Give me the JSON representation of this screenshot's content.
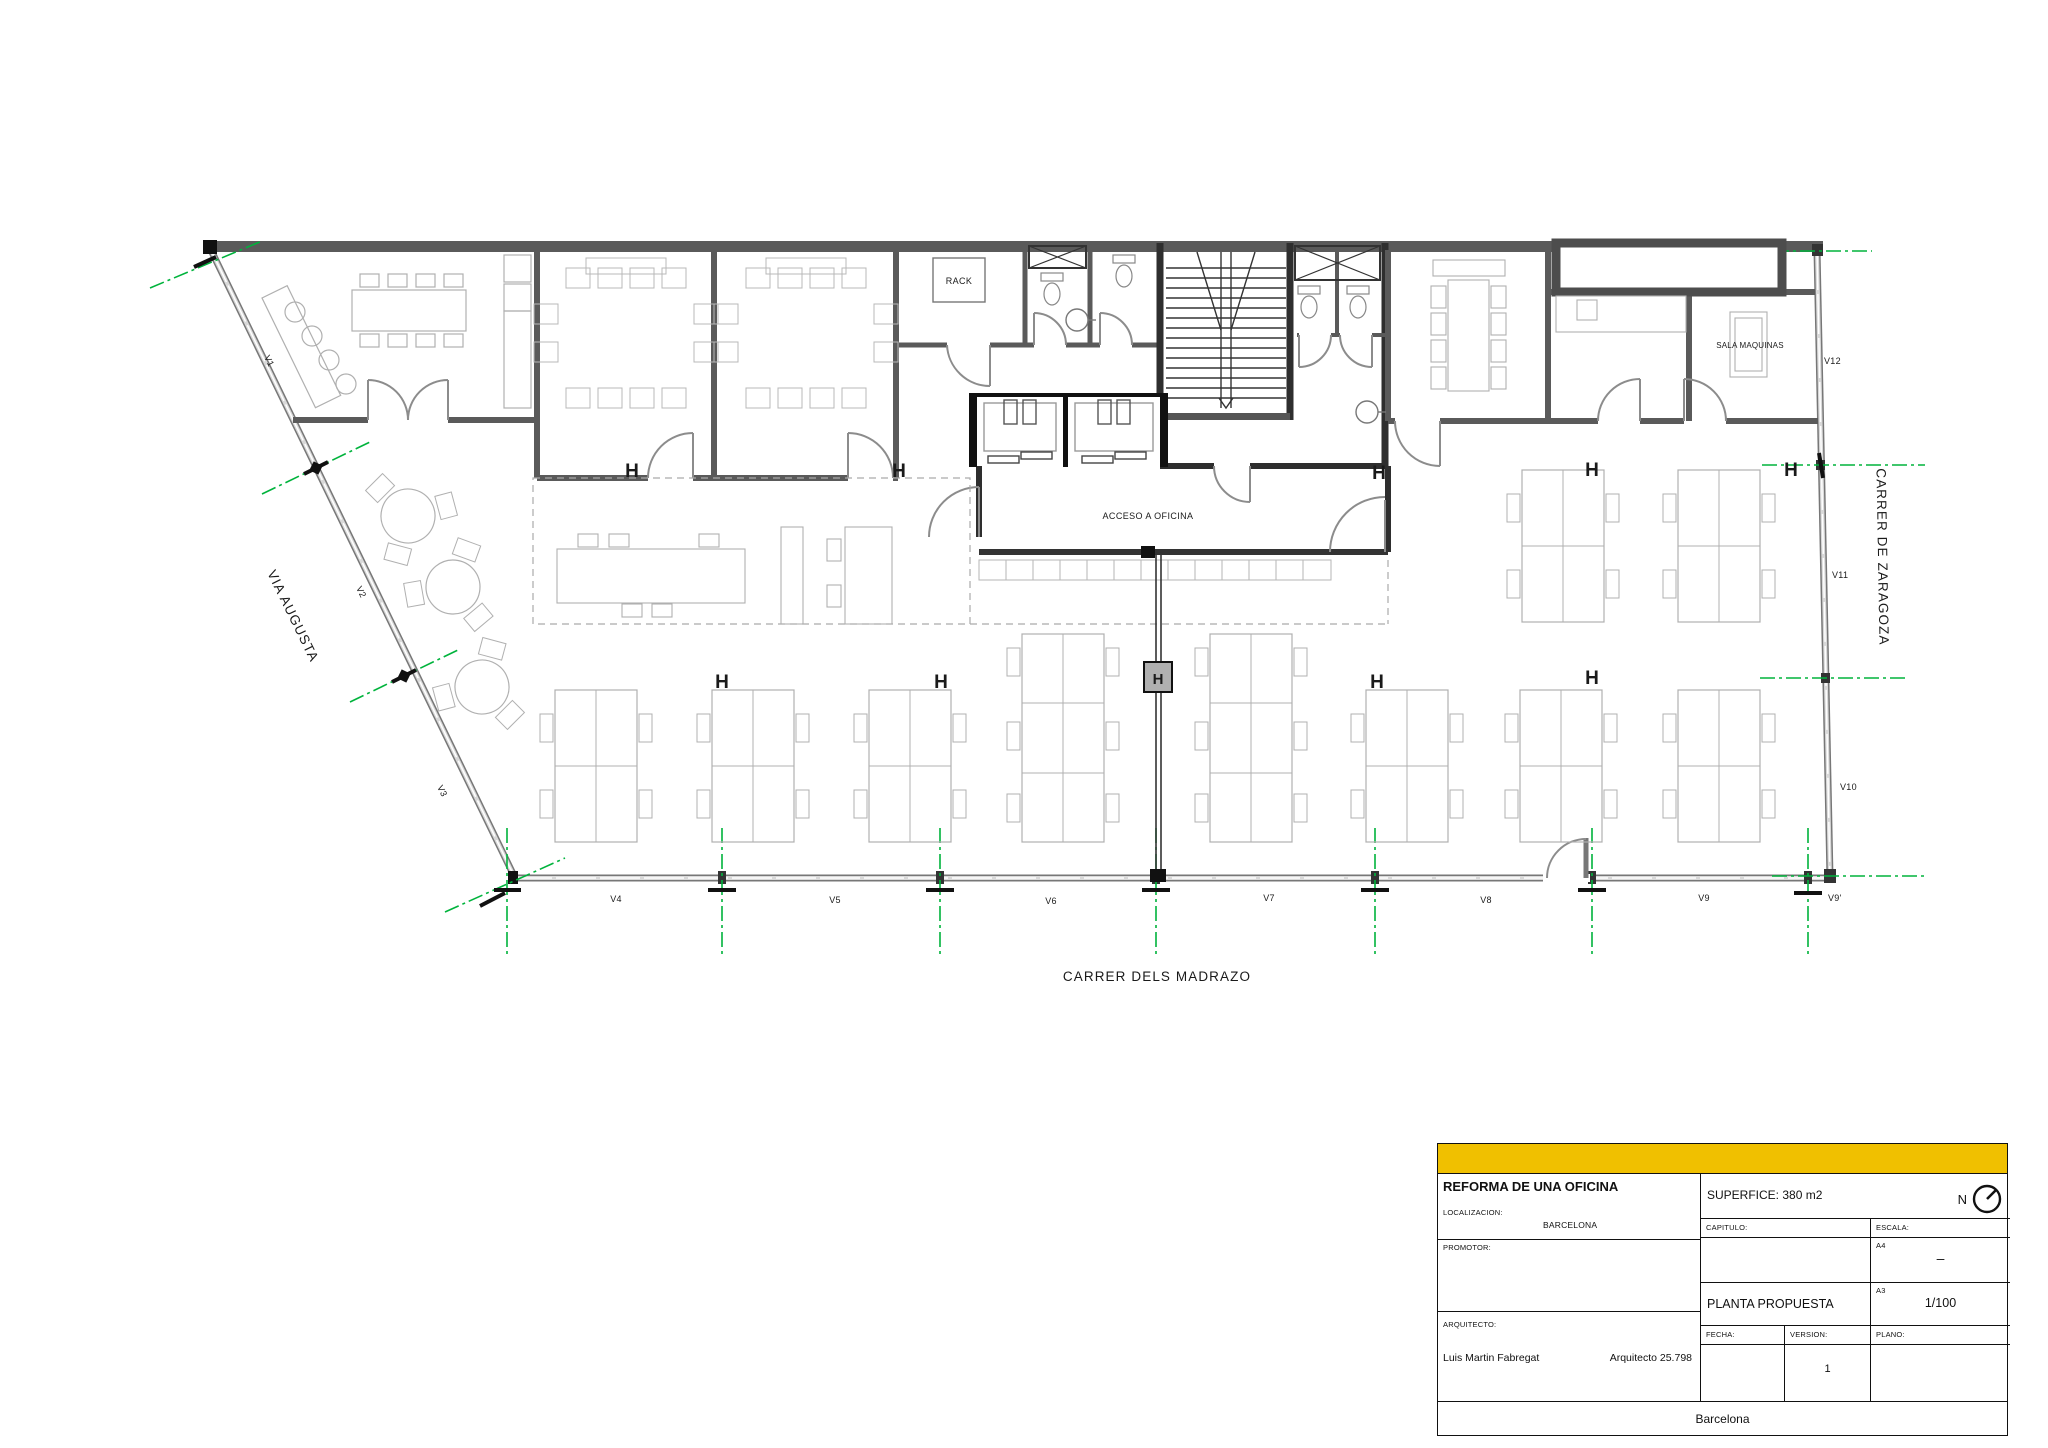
{
  "plan": {
    "streets": {
      "left": "VIA AUGUSTA",
      "bottom": "CARRER DELS MADRAZO",
      "right": "CARRER DE ZARAGOZA"
    },
    "rooms": {
      "rack": "RACK",
      "sala_maquinas": "SALA MAQUINAS",
      "acceso": "ACCESO A OFICINA"
    },
    "windows": [
      "V1",
      "V2",
      "V3",
      "V4",
      "V5",
      "V6",
      "V7",
      "V8",
      "V9",
      "V9'",
      "V10",
      "V11",
      "V12"
    ],
    "column_marker": "H",
    "axis_color": "#00b33c"
  },
  "title_block": {
    "accent_color": "#f0c000",
    "project_title": "REFORMA DE UNA OFICINA",
    "localizacion_label": "LOCALIZACION:",
    "localizacion_value": "BARCELONA",
    "promotor_label": "PROMOTOR:",
    "arquitecto_label": "ARQUITECTO:",
    "arquitecto_name": "Luis Martin Fabregat",
    "arquitecto_number": "Arquitecto 25.798",
    "superficie": "SUPERFICE: 380 m2",
    "north_letter": "N",
    "capitulo_label": "CAPITULO:",
    "escala_label": "ESCALA:",
    "a4_label": "A4",
    "a4_value": "–",
    "plano_title": "PLANTA PROPUESTA",
    "a3_label": "A3",
    "a3_value": "1/100",
    "fecha_label": "FECHA:",
    "version_label": "VERSION:",
    "version_value": "1",
    "plano_label": "PLANO:",
    "city": "Barcelona"
  }
}
